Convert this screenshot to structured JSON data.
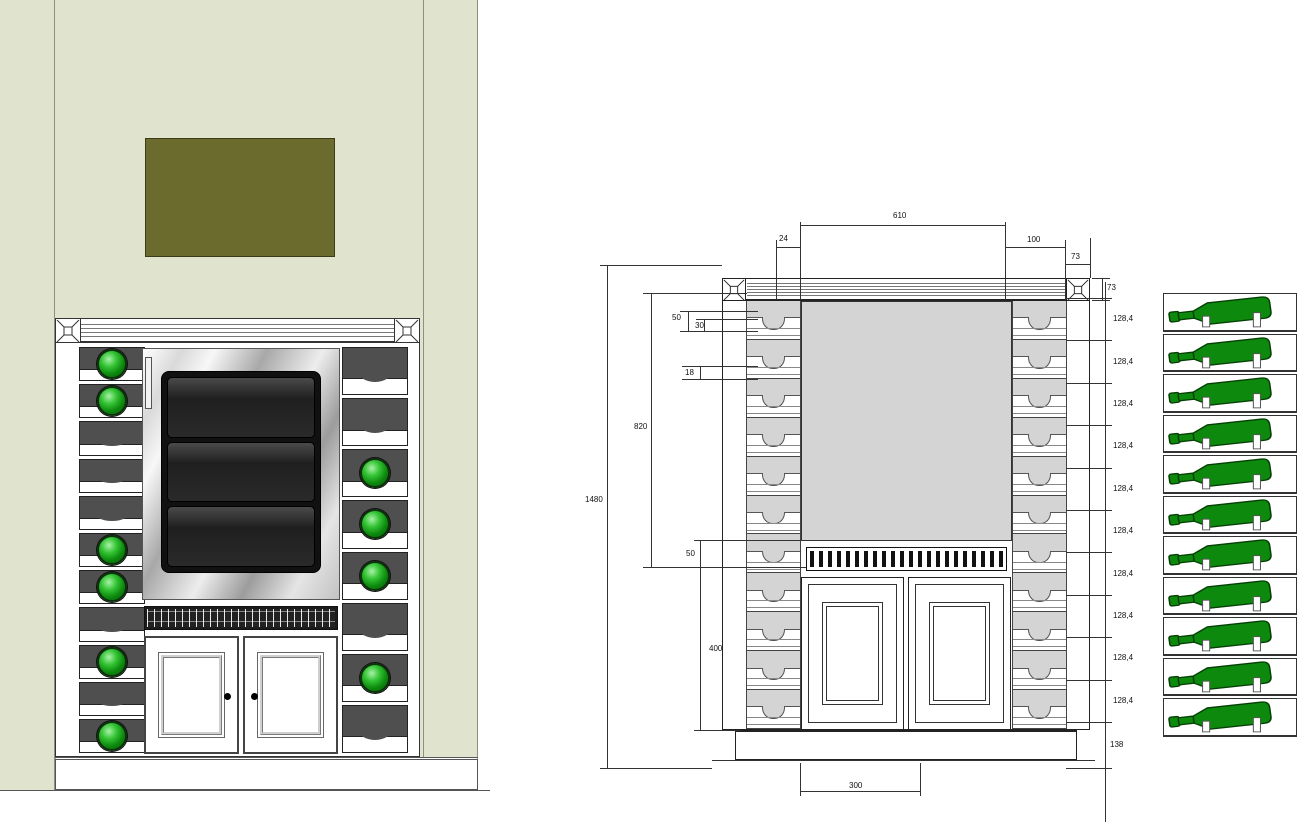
{
  "colors": {
    "wall": "#e0e4cf",
    "picture_olive": "#6b6b2e",
    "slot_dark": "#4f4f4f",
    "bottle_green": "#0d8a0d",
    "drawing_gray": "#d4d4d4",
    "screen_dark": "#1c1c1c"
  },
  "render_view": {
    "left_rack_slots": [
      "bottle",
      "bottle",
      "empty",
      "empty",
      "empty",
      "bottle",
      "bottle",
      "empty",
      "bottle",
      "empty",
      "bottle"
    ],
    "right_rack_slots": [
      "empty",
      "empty",
      "bottle",
      "bottle",
      "bottle",
      "empty",
      "bottle",
      "empty"
    ]
  },
  "drawing": {
    "rack_slot_count": 11,
    "dims": {
      "panel_width": "610",
      "left_gap": "24",
      "right_inset": "100",
      "corner_width": "73",
      "corner_height": "73",
      "overall_height": "1480",
      "upper_height": "820",
      "detail_50_top": "50",
      "detail_30": "30",
      "detail_18": "18",
      "grille_height": "50",
      "door_height": "400",
      "door_width": "300",
      "base_height": "138",
      "slot_pitch": "128,4"
    },
    "right_chain_labels": [
      "128,4",
      "128,4",
      "128,4",
      "128,4",
      "128,4",
      "128,4",
      "128,4",
      "128,4",
      "128,4",
      "128,4"
    ]
  },
  "bottle_view": {
    "bottle_count": 11
  }
}
